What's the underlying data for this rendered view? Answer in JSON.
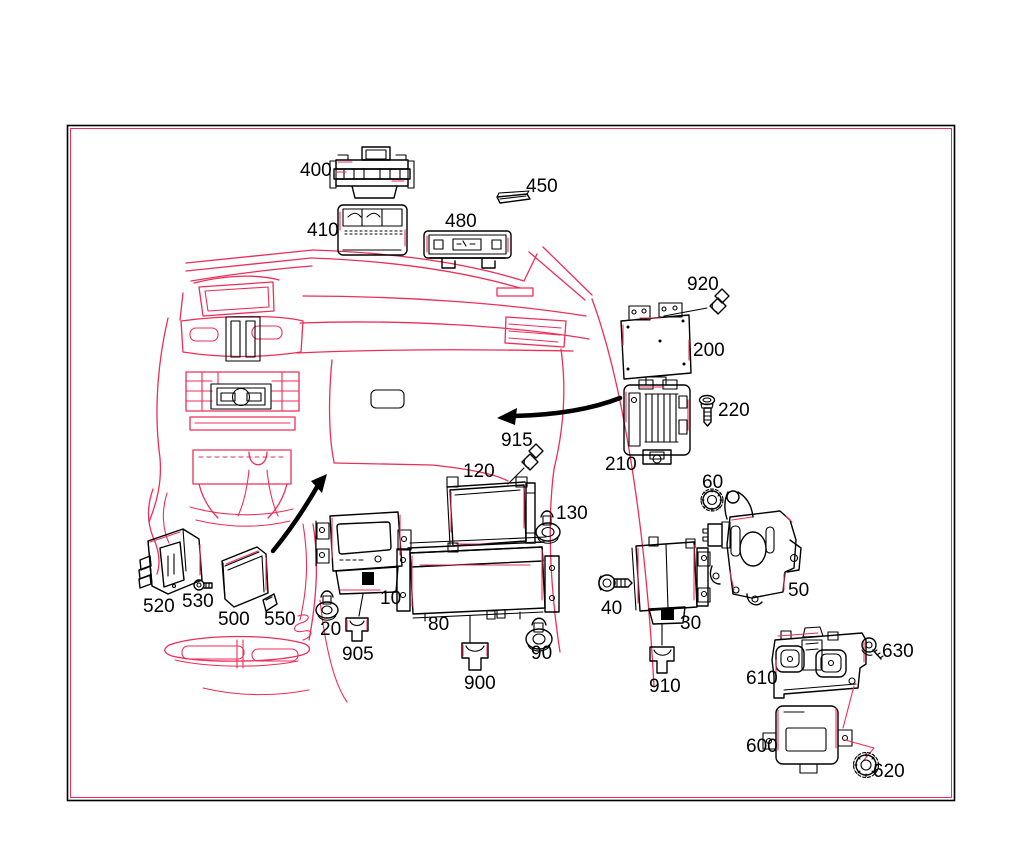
{
  "page": {
    "kind": "exploded-parts-diagram",
    "background": "#ffffff",
    "ink_color": "#000000",
    "accent_color": "#ed2e58"
  },
  "diagram": {
    "frame": {
      "x": 67,
      "y": 125,
      "width": 888,
      "height": 676
    },
    "labels": [
      {
        "text": "400",
        "x": 300,
        "y": 161,
        "part": "mounting-frame"
      },
      {
        "text": "410",
        "x": 307,
        "y": 221,
        "part": "overhead-control-panel"
      },
      {
        "text": "450",
        "x": 526,
        "y": 177,
        "part": "trim-strip"
      },
      {
        "text": "480",
        "x": 445,
        "y": 212,
        "part": "display-unit"
      },
      {
        "text": "920",
        "x": 687,
        "y": 275,
        "part": "clip"
      },
      {
        "text": "200",
        "x": 693,
        "y": 341,
        "part": "control-module"
      },
      {
        "text": "220",
        "x": 718,
        "y": 401,
        "part": "screw"
      },
      {
        "text": "915",
        "x": 501,
        "y": 431,
        "part": "clip"
      },
      {
        "text": "210",
        "x": 605,
        "y": 455,
        "part": "carrier-bracket"
      },
      {
        "text": "120",
        "x": 463,
        "y": 462,
        "part": "module"
      },
      {
        "text": "130",
        "x": 556,
        "y": 504,
        "part": "expansion-rivet"
      },
      {
        "text": "60",
        "x": 702,
        "y": 473,
        "part": "nut"
      },
      {
        "text": "50",
        "x": 788,
        "y": 581,
        "part": "bracket"
      },
      {
        "text": "10",
        "x": 380,
        "y": 589,
        "part": "head-unit"
      },
      {
        "text": "20",
        "x": 320,
        "y": 620,
        "part": "expansion-rivet"
      },
      {
        "text": "905",
        "x": 342,
        "y": 645,
        "part": "clip"
      },
      {
        "text": "80",
        "x": 428,
        "y": 615,
        "part": "display"
      },
      {
        "text": "90",
        "x": 531,
        "y": 644,
        "part": "expansion-rivet"
      },
      {
        "text": "900",
        "x": 464,
        "y": 674,
        "part": "clip"
      },
      {
        "text": "40",
        "x": 601,
        "y": 599,
        "part": "screw"
      },
      {
        "text": "30",
        "x": 680,
        "y": 614,
        "part": "control-module"
      },
      {
        "text": "910",
        "x": 649,
        "y": 677,
        "part": "clip"
      },
      {
        "text": "520",
        "x": 143,
        "y": 597,
        "part": "control-module"
      },
      {
        "text": "530",
        "x": 182,
        "y": 592,
        "part": "screw"
      },
      {
        "text": "500",
        "x": 218,
        "y": 610,
        "part": "cover-plate"
      },
      {
        "text": "550",
        "x": 264,
        "y": 610,
        "part": "chip-card"
      },
      {
        "text": "610",
        "x": 746,
        "y": 669,
        "part": "bracket-plate"
      },
      {
        "text": "630",
        "x": 882,
        "y": 642,
        "part": "screw"
      },
      {
        "text": "600",
        "x": 746,
        "y": 737,
        "part": "control-module"
      },
      {
        "text": "620",
        "x": 873,
        "y": 762,
        "part": "nut"
      }
    ]
  }
}
